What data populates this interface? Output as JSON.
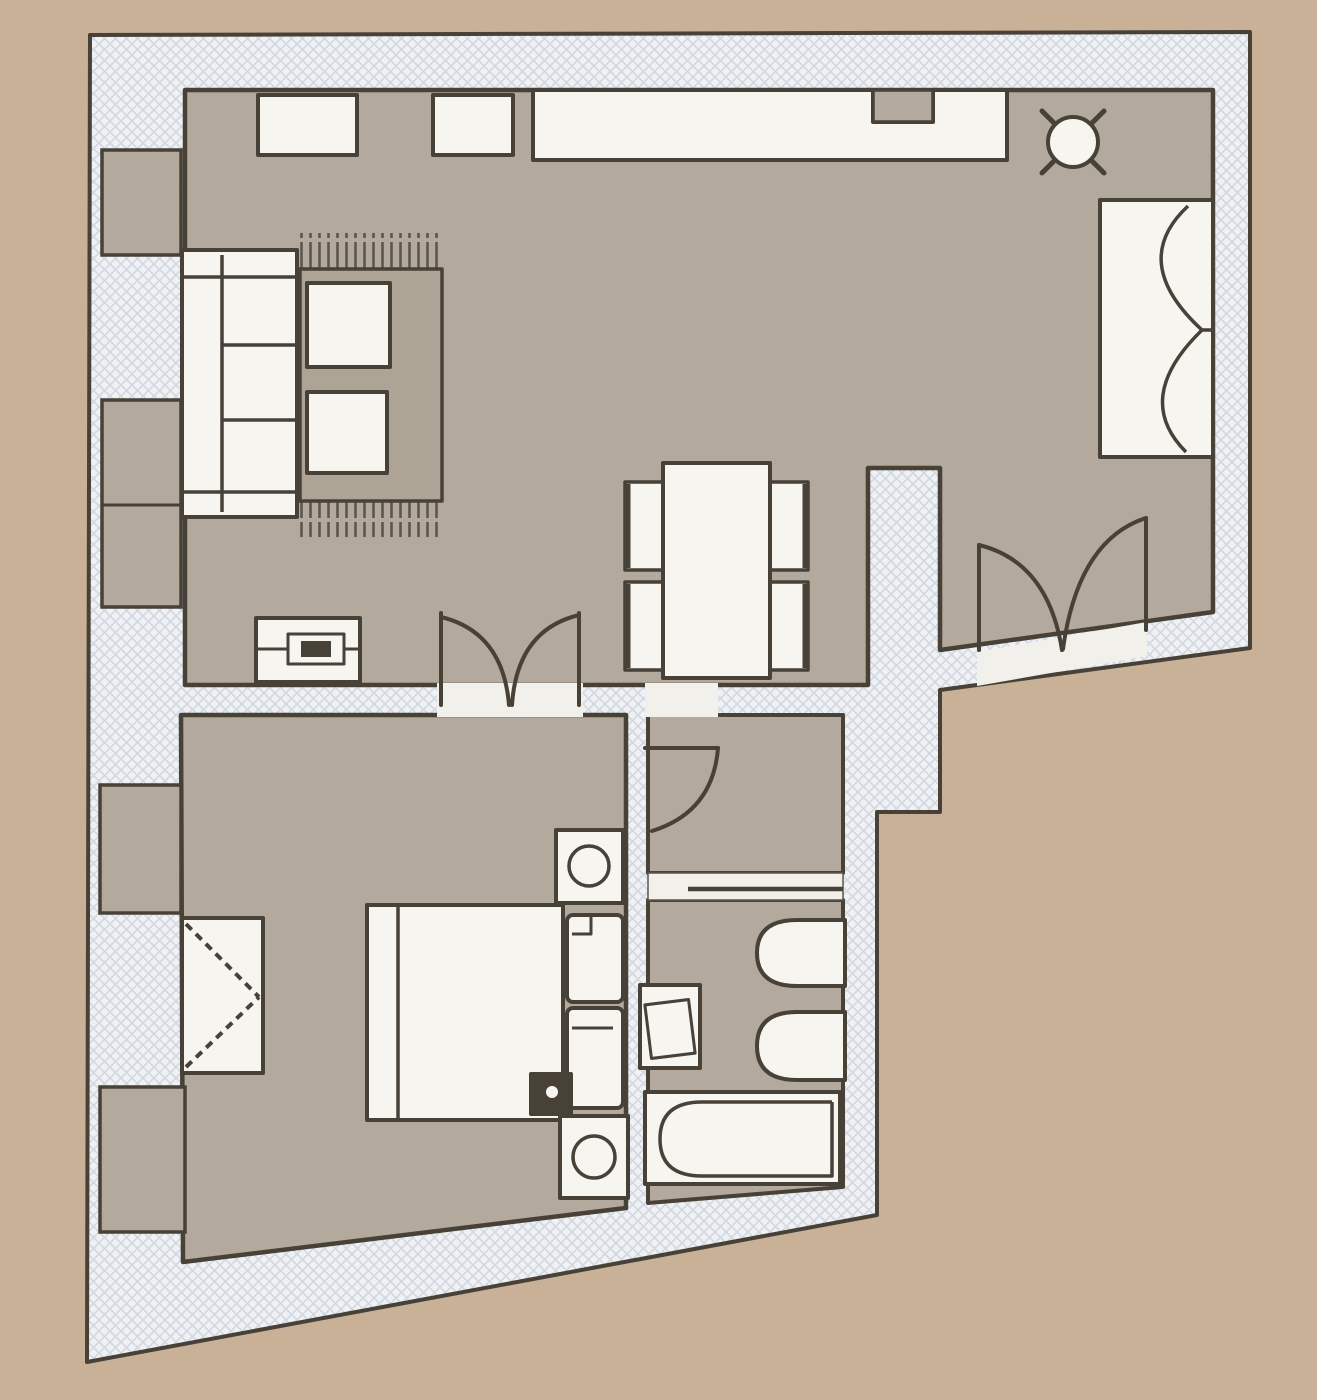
{
  "plan": {
    "type": "apartment-floor-plan",
    "rooms": [
      {
        "name": "living-dining-kitchen"
      },
      {
        "name": "bedroom"
      },
      {
        "name": "hallway"
      },
      {
        "name": "bathroom"
      }
    ],
    "furniture": [
      "sideboard",
      "wall-cabinet",
      "kitchen-counter",
      "counter-sink-recess",
      "round-bistro-table",
      "casement-window-recess",
      "sofa",
      "rug",
      "coffee-table",
      "coffee-table",
      "tv-console",
      "tv-set",
      "dining-table",
      "dining-chair",
      "dining-chair",
      "dining-chair",
      "dining-chair",
      "wardrobe",
      "double-bed",
      "pillow",
      "pillow",
      "nightstand-with-lamp",
      "nightstand-with-lamp",
      "bedside-stool",
      "washbasin",
      "toilet",
      "bidet",
      "bathtub"
    ],
    "doors": [
      "double-door-living-to-bedroom",
      "entrance-double-door",
      "hallway-single-door",
      "bathroom-sliding-door"
    ],
    "windows": [
      "left-wall-window-bay-1",
      "left-wall-window-bay-2",
      "left-wall-window-bay-3",
      "left-wall-window-bay-4"
    ]
  },
  "colors": {
    "outside": "#c9b197",
    "floor": "#b3a99c",
    "wall_base": "#f0f1f4",
    "wall_hatch": "#d2d8e0",
    "furniture": "#f6f5ef",
    "line": "#474138",
    "line_soft": "#5d564b",
    "opening": "#f1f0ea"
  }
}
